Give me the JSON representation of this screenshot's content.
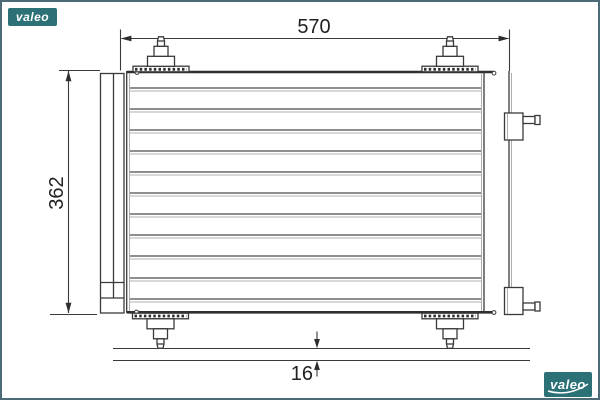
{
  "page": {
    "background": "#ffffff",
    "frame_color": "#4d6b76"
  },
  "dimensions": {
    "width": {
      "label": "570"
    },
    "height": {
      "label": "362"
    },
    "depth": {
      "label": "16"
    }
  },
  "branding": {
    "watermark_top_left": "valeo",
    "watermark_bottom_right": "valeo",
    "brand_color": "#2b7176",
    "text_color": "#ffffff"
  },
  "figure": {
    "type": "engineering-drawing",
    "fin_rows": 11,
    "mounting_studs": 4,
    "side_ports": 2
  }
}
